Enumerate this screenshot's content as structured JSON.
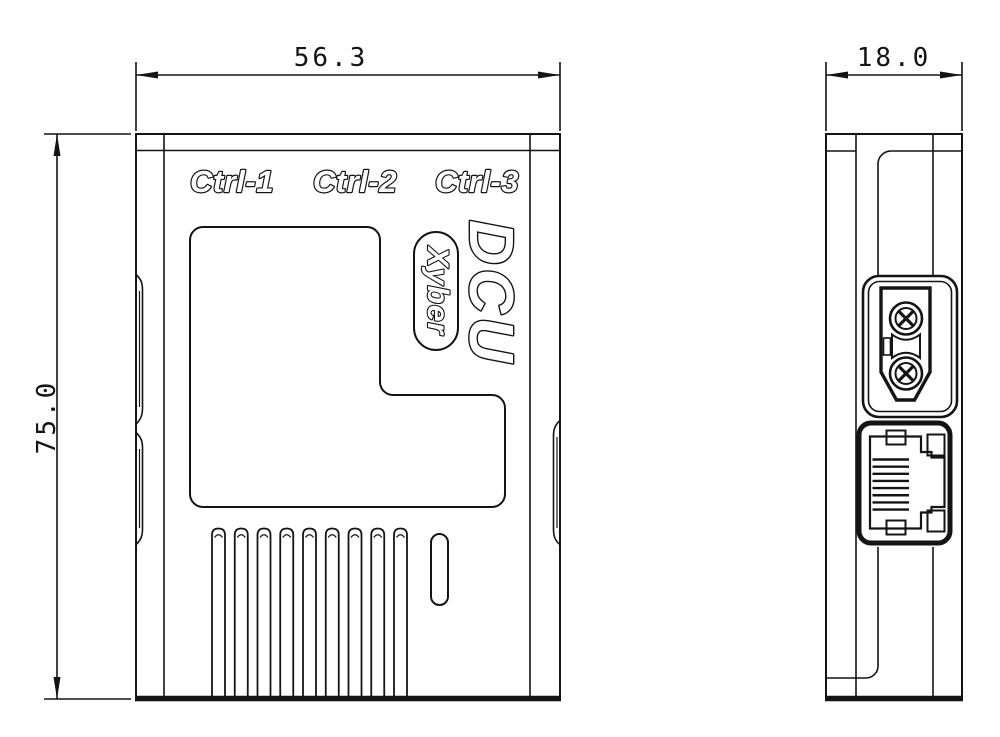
{
  "drawing_labels": {
    "ctrl_1": "Ctrl-1",
    "ctrl_2": "Ctrl-2",
    "ctrl_3": "Ctrl-3",
    "product_logo": "DCU",
    "brand_badge": "Xyber"
  },
  "dimensions": {
    "front_width": "56.3",
    "front_height": "75.0",
    "side_depth": "18.0"
  },
  "front_view": {
    "vent_slot_count": 9
  },
  "side_view": {
    "ethernet_pin_count": 8,
    "power_terminal_count": 2
  },
  "colors": {
    "line": "#141414",
    "background": "#ffffff"
  }
}
